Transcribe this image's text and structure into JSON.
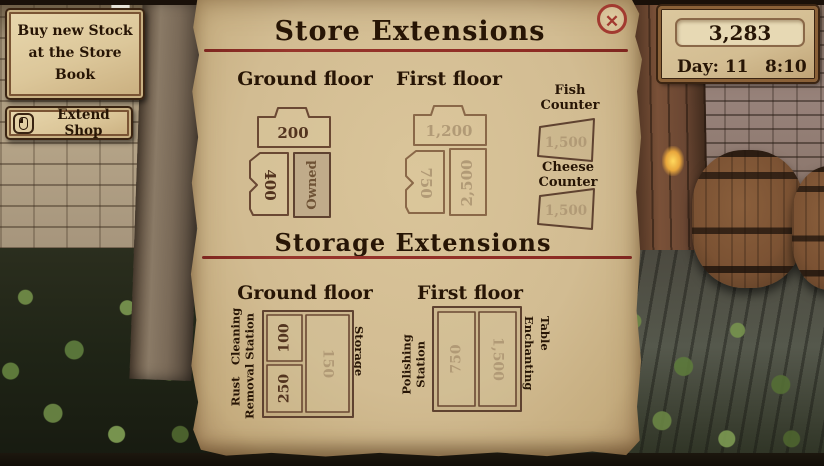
{
  "colors": {
    "parchment": "#d2bc92",
    "rule_red": "#8e2c24",
    "ink": "#271505",
    "price_active": "#53341f",
    "price_faded": "#b19a76",
    "close_red": "#a23a30"
  },
  "icons": {
    "close": "✕",
    "mouse": "mouse-left-click-icon"
  },
  "hud": {
    "stock_tooltip": "Buy new Stock at the Store Book",
    "extend_shop": "Extend Shop",
    "money": "3,283",
    "day": "Day: 11",
    "time": "8:10"
  },
  "store_extensions": {
    "title": "Store Extensions",
    "ground": {
      "header": "Ground floor",
      "top_price": "200",
      "left_price": "400",
      "right_status": "Owned"
    },
    "first": {
      "header": "First floor",
      "top_price": "1,200",
      "left_price": "750",
      "right_price": "2,500"
    },
    "counters": {
      "fish_label": "Fish Counter",
      "fish_price": "1,500",
      "cheese_label": "Cheese Counter",
      "cheese_price": "1,500"
    }
  },
  "storage_extensions": {
    "title": "Storage Extensions",
    "ground": {
      "header": "Ground floor",
      "cleaning_label": [
        "Cleaning",
        "Station"
      ],
      "rust_label": [
        "Rust",
        "Removal"
      ],
      "storage_label": "Storage",
      "prices": {
        "cleaning": "100",
        "rust": "250",
        "storage": "150"
      }
    },
    "first": {
      "header": "First floor",
      "polishing_label": [
        "Polishing",
        "Station"
      ],
      "enchanting_label": [
        "Enchanting",
        "Table"
      ],
      "prices": {
        "polishing": "750",
        "enchanting": "1,500"
      }
    }
  }
}
